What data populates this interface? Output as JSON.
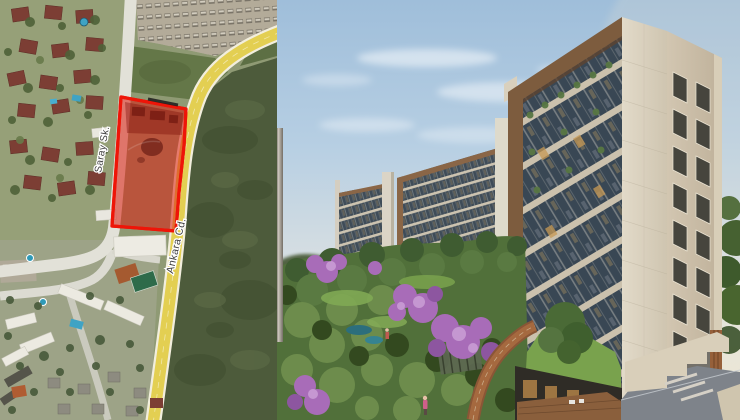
{
  "map": {
    "street_labels": [
      {
        "text": "Saray Sk."
      },
      {
        "text": "Ankara Cd."
      }
    ],
    "parcel": {
      "fill": "rgba(221,30,16,0.55)",
      "stroke": "#ee1508"
    },
    "colors": {
      "main_road": "#e3cf52",
      "main_road_edge": "#f2eedd",
      "side_road": "#e2e1d8",
      "field": "#4d5b3b",
      "grass_strip": "#647748",
      "parking": "#b3ab99",
      "residential_base": "#96a078"
    }
  },
  "render": {
    "colors": {
      "sky_top": "#9fbeda",
      "sky_horizon": "#ece6d4",
      "stone_facade": "#d9d0bf",
      "wood_frame": "#7d5c3e",
      "window_glass": "#394754",
      "foliage_green": "#4e6b3a",
      "bloom_purple": "#a86cb8",
      "lawn_green": "#79a24d",
      "plaza_gray": "#7e838a"
    }
  }
}
